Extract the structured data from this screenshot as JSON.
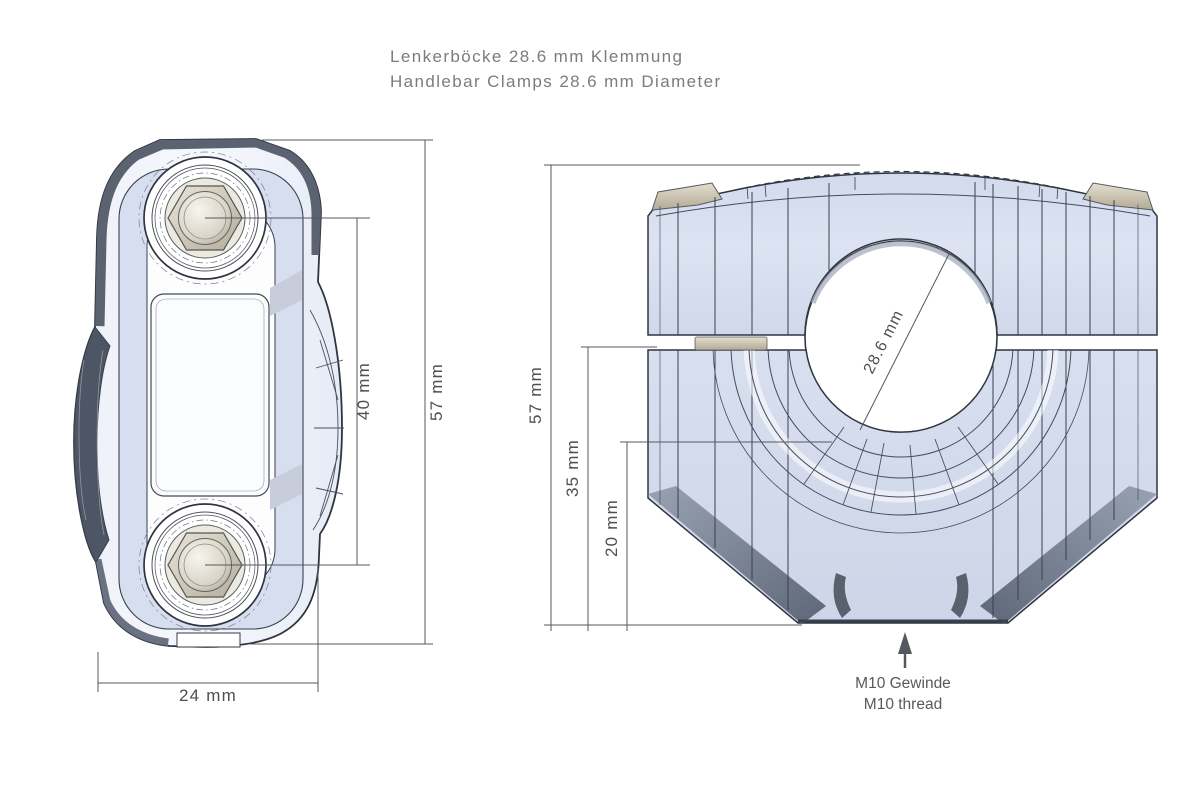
{
  "title": {
    "line1": "Lenkerböcke 28.6 mm Klemmung",
    "line2": "Handlebar Clamps 28.6 mm Diameter"
  },
  "top_view": {
    "dim_bolt_spacing": "40 mm",
    "dim_overall_length": "57 mm",
    "dim_width": "24 mm"
  },
  "front_view": {
    "dim_overall_height": "57 mm",
    "dim_to_gap": "35 mm",
    "dim_lower": "20 mm",
    "dim_bore": "28.6 mm",
    "thread_note_de": "M10 Gewinde",
    "thread_note_en": "M10 thread"
  },
  "colors": {
    "background": "#ffffff",
    "title_text": "#7c7c7c",
    "dimension_lines": "#55585e",
    "body_light": "#e3e8f4",
    "body_blue_panel": "#d6deef",
    "edge_dark": "#5b6270",
    "outline": "#2f3540",
    "washer_tan": "#cfc8b5"
  }
}
